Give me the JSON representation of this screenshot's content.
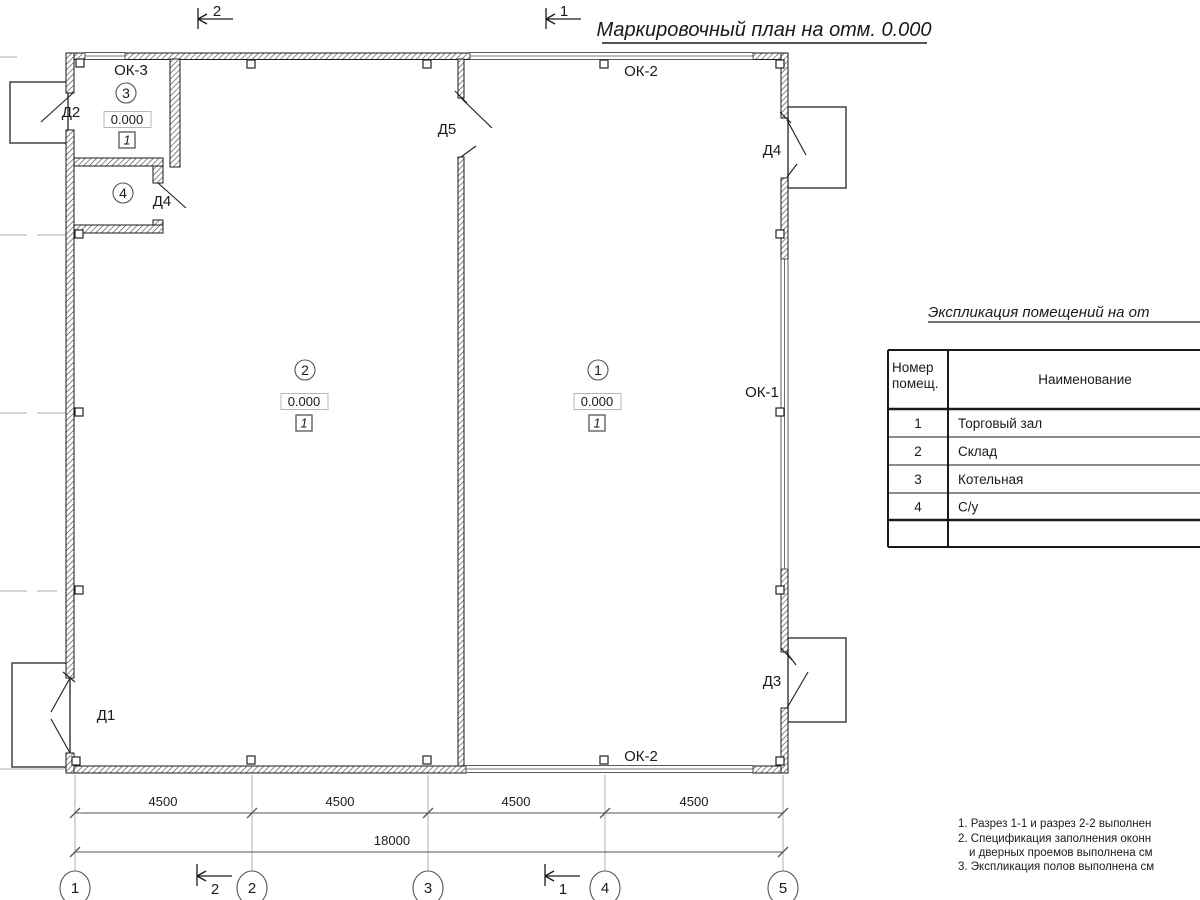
{
  "title": "Маркировочный план на отм. 0.000",
  "colors": {
    "ink": "#1a1a1a",
    "axis_gray": "#aeaeae",
    "paper": "#ffffff"
  },
  "sections": [
    {
      "label": "2"
    },
    {
      "label": "1"
    }
  ],
  "plan": {
    "rooms": [
      {
        "number": "1",
        "elevation": "0.000",
        "floor_type": "1"
      },
      {
        "number": "2",
        "elevation": "0.000",
        "floor_type": "1"
      },
      {
        "number": "3",
        "elevation": "0.000",
        "floor_type": "1"
      },
      {
        "number": "4"
      }
    ],
    "doors": {
      "d1": "Д1",
      "d2": "Д2",
      "d3": "Д3",
      "d4_entry": "Д4",
      "d4_wc": "Д4",
      "d5": "Д5"
    },
    "windows": {
      "ok1": "ОК-1",
      "ok2_top": "ОК-2",
      "ok2_bottom": "ОК-2",
      "ok3": "ОК-3"
    }
  },
  "dimensions": {
    "segments": [
      "4500",
      "4500",
      "4500",
      "4500"
    ],
    "total": "18000"
  },
  "axes": [
    "1",
    "2",
    "3",
    "4",
    "5"
  ],
  "table": {
    "title": "Экспликация помещений на от",
    "col1_header_line1": "Номер",
    "col1_header_line2": "помещ.",
    "col2_header": "Наименование",
    "rows": [
      {
        "num": "1",
        "name": "Торговый зал"
      },
      {
        "num": "2",
        "name": "Склад"
      },
      {
        "num": "3",
        "name": "Котельная"
      },
      {
        "num": "4",
        "name": "С/у"
      }
    ]
  },
  "notes": [
    "1. Разрез 1-1 и разрез 2-2 выполнен",
    "2. Спецификация заполнения оконн",
    "и дверных проемов выполнена см",
    "3. Экспликация полов выполнена см"
  ]
}
